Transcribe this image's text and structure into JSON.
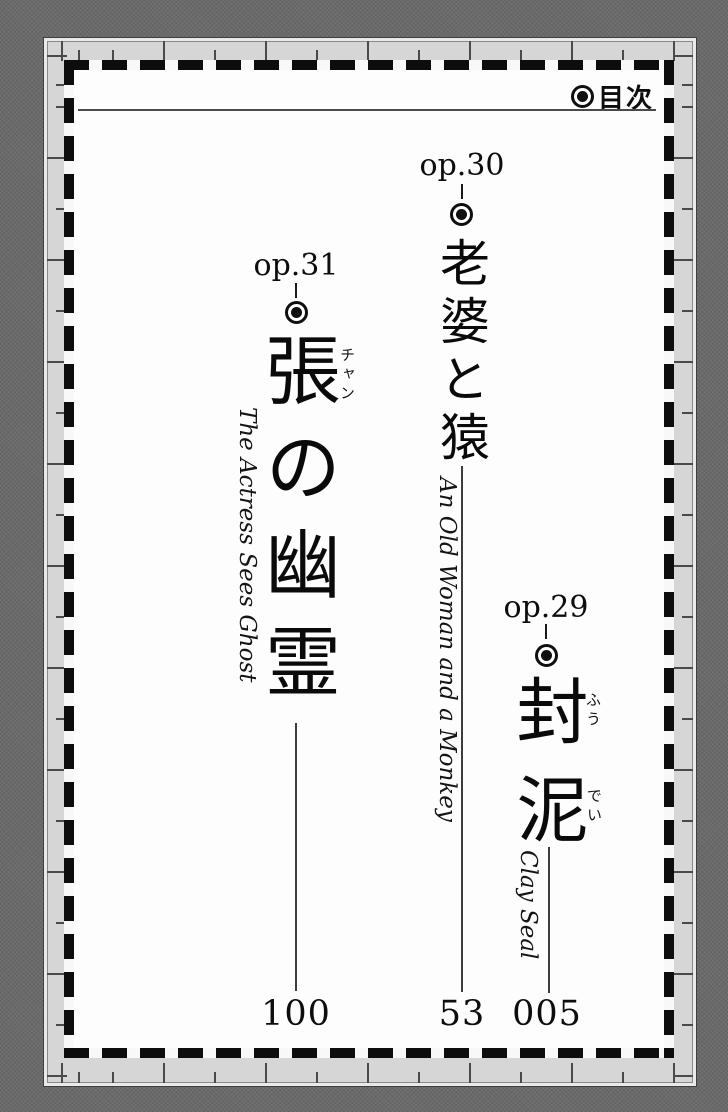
{
  "header": {
    "icon": "bullseye",
    "title": "目次"
  },
  "entries": [
    {
      "number": "op.29",
      "icon": "bullseye",
      "title": "封泥",
      "furigana": [
        {
          "text": "ふう",
          "for": "封"
        },
        {
          "text": "でい",
          "for": "泥"
        }
      ],
      "subtitle_en": "Clay Seal",
      "page_number": "005"
    },
    {
      "number": "op.30",
      "icon": "bullseye",
      "title": "老婆と猿",
      "furigana": [],
      "subtitle_en": "An Old Woman and a Monkey",
      "page_number": "53"
    },
    {
      "number": "op.31",
      "icon": "bullseye",
      "title": "張の幽霊",
      "furigana": [
        {
          "text": "チャン",
          "for": "張"
        }
      ],
      "subtitle_en": "The Actress Sees Ghost",
      "page_number": "100"
    }
  ],
  "colors": {
    "ink": "#111111",
    "page_background": "#fdfdfd",
    "frame_band": "#d6d6d6",
    "outer_background": "#6a6a6a"
  }
}
